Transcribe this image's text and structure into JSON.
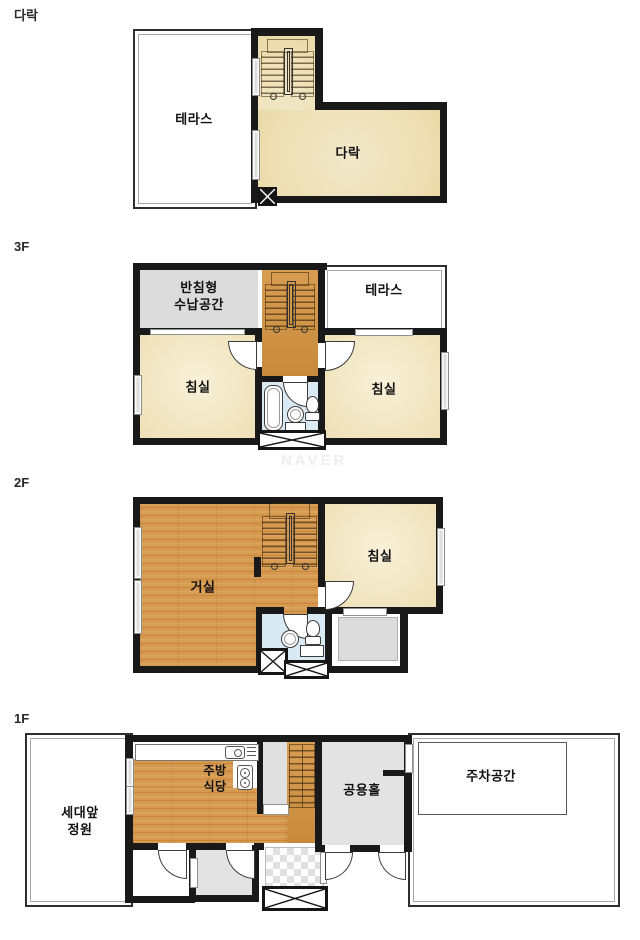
{
  "watermark": "NAVER",
  "colors": {
    "wall": "#191919",
    "attic_floor": "#eddfb3",
    "bedroom_floor": "#f1e5c0",
    "wood_floor": "#d6994e",
    "stair_wood": "#d3954a",
    "storage_gray": "#dcdcdc",
    "hall_gray": "#e3e3e3",
    "bath_blue": "#d9eaf4",
    "window_gray": "#dedede"
  },
  "floors": {
    "attic": {
      "label": "다락",
      "rooms": {
        "terrace": "테라스",
        "loft": "다락"
      }
    },
    "f3": {
      "label": "3F",
      "rooms": {
        "storage": "반침형\n수납공간",
        "terrace": "테라스",
        "bedroom_left": "침실",
        "bedroom_right": "침실"
      }
    },
    "f2": {
      "label": "2F",
      "rooms": {
        "living": "거실",
        "bedroom": "침실"
      }
    },
    "f1": {
      "label": "1F",
      "rooms": {
        "garden": "세대앞\n정원",
        "kitchen": "주방\n식당",
        "hall": "공용홀",
        "parking": "주차공간"
      }
    }
  }
}
